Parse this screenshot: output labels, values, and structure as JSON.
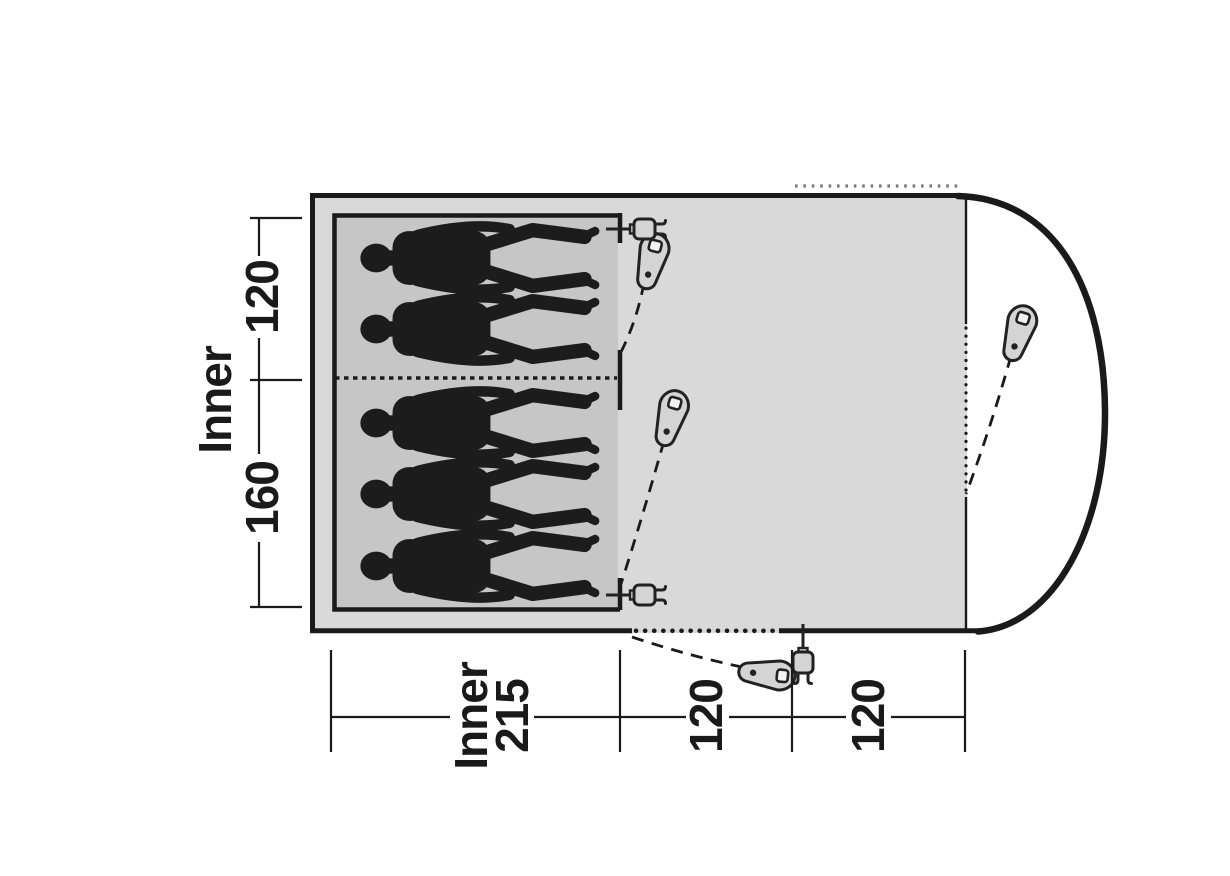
{
  "diagram": {
    "type": "tent-floorplan",
    "dimensions": {
      "left": {
        "title": "Inner",
        "segments": [
          "120",
          "160"
        ]
      },
      "bottom": {
        "segments": [
          {
            "line1": "Inner",
            "line2": "215"
          },
          {
            "value": "120"
          },
          {
            "value": "120"
          }
        ]
      }
    },
    "sleeping": {
      "top_cabin_persons": 2,
      "bottom_cabin_persons": 3,
      "total_persons": 5
    },
    "icons": {
      "zip_puller_count": 4,
      "power_cable_entry_count": 3,
      "glyph_names": [
        "zip-puller-icon",
        "power-plug-icon",
        "sleeping-person-figure"
      ]
    },
    "colors": {
      "background": "#ffffff",
      "tent_fill": "#d9d9d9",
      "inner_cabin_fill": "#c6c6c6",
      "outline": "#1a1a1a",
      "icon_fill": "#d4d4d4",
      "vent_dots": "#7a7a7a"
    }
  }
}
